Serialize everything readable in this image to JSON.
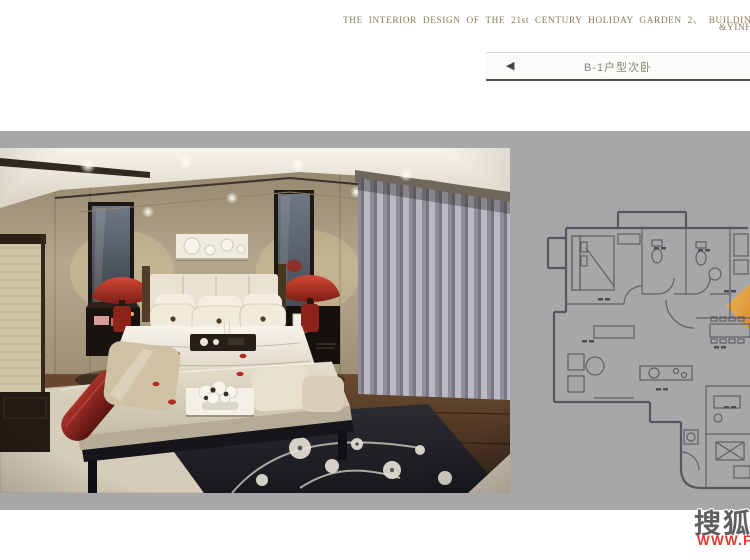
{
  "header": {
    "line1": "THE  INTERIOR  DESIGN  OF  THE  21st  CENTURY  HOLIDAY  GARDEN  2、 BUILDING 2、 MODEL  AND  ENTRA",
    "line2": "&YINH",
    "text_color": "#8d7a53"
  },
  "navbar": {
    "back_icon": "◀",
    "title": "B-1户型次卧"
  },
  "stage": {
    "background": "#a7a7a7"
  },
  "floorplan": {
    "line_color": "#5d6066",
    "highlight_cone_color": "#e89a35"
  },
  "watermark": {
    "logo": "搜狐",
    "url": "WWW.F",
    "url_color": "#e23a2e"
  }
}
